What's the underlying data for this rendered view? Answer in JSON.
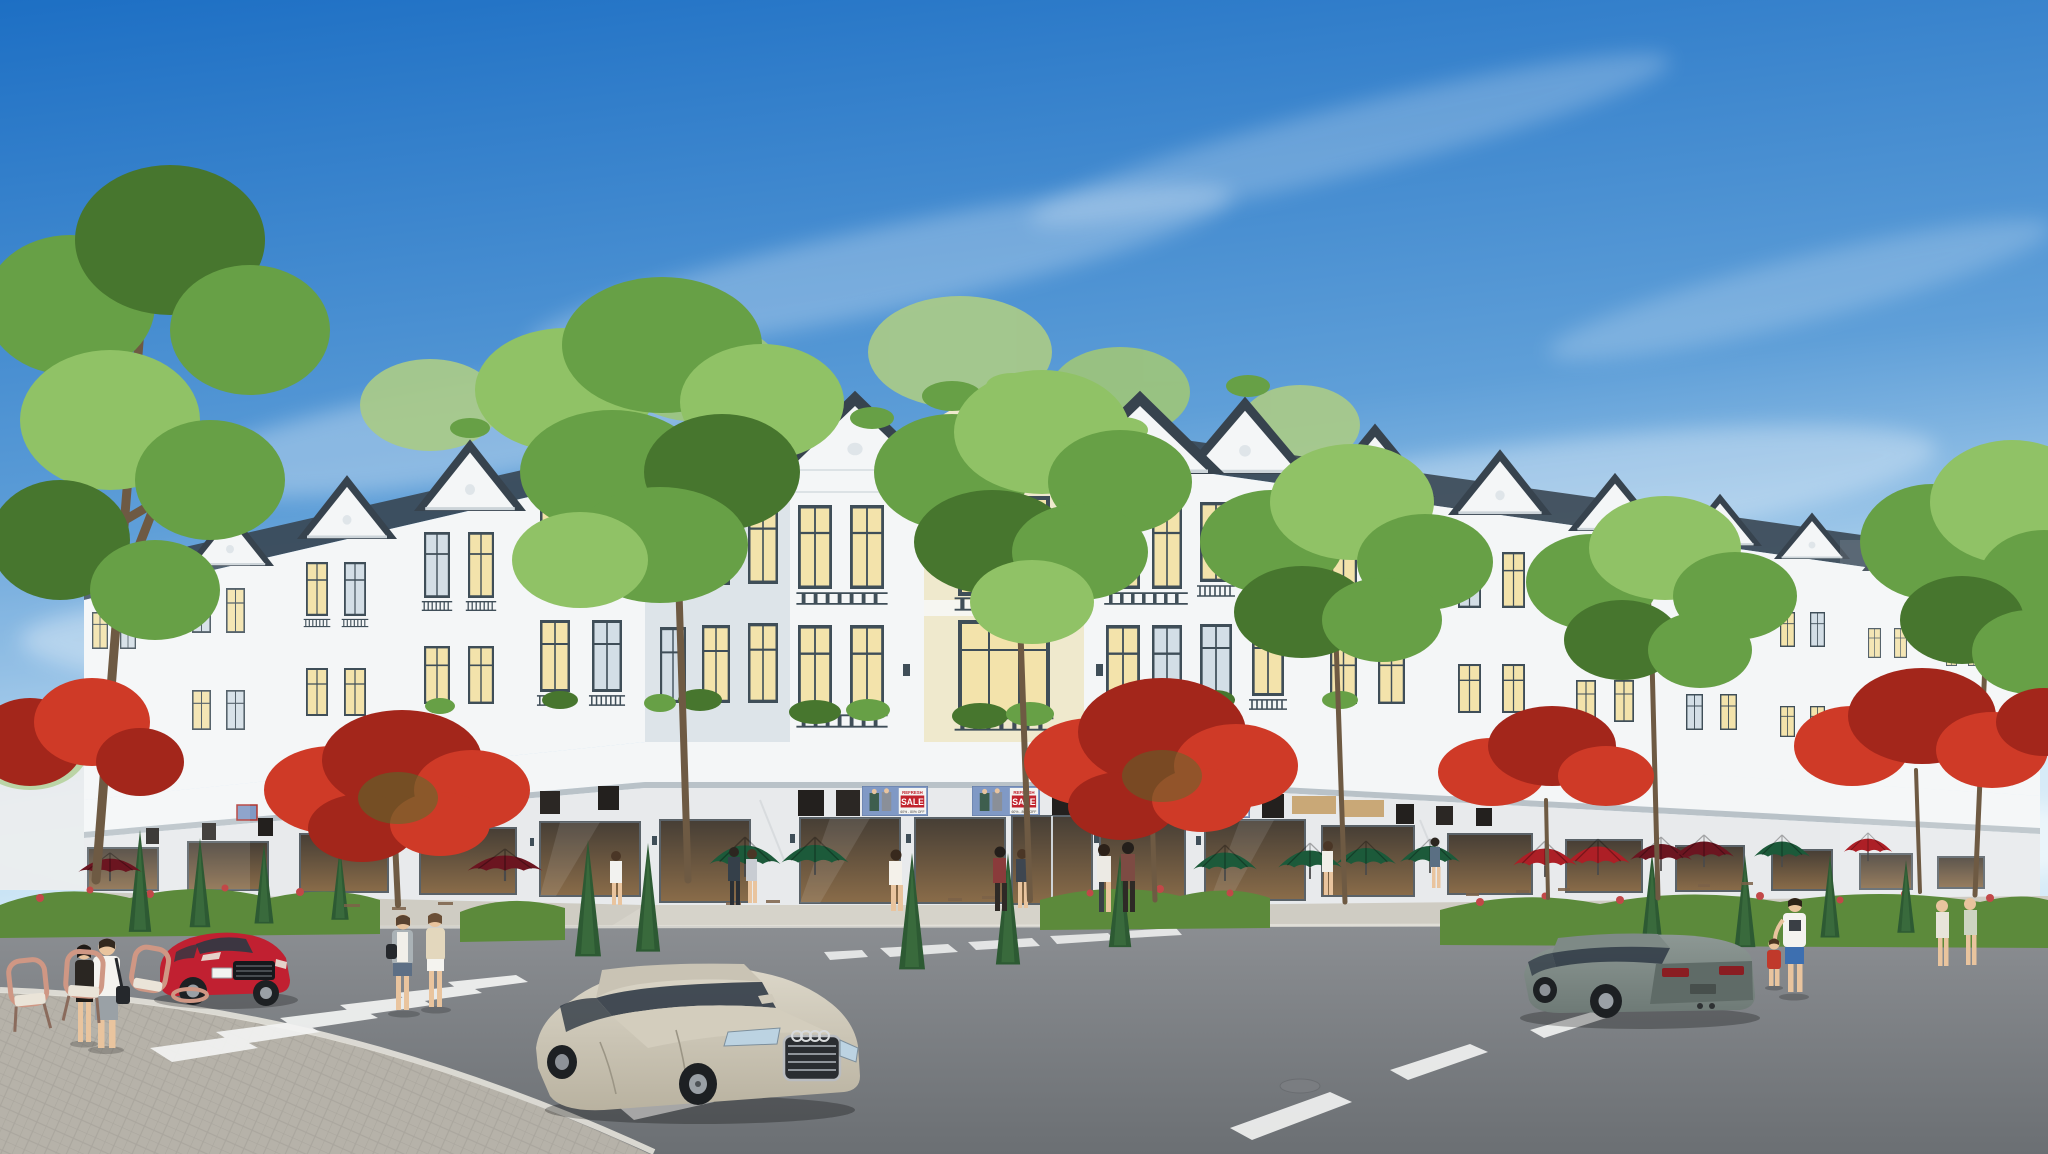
{
  "scene": {
    "kind": "3D architectural rendering",
    "setting": "Sunny street corner of a white neoclassical shophouse row with street trees, cafe umbrellas, pedestrians and three cars",
    "signage": {
      "banner_refresh": "REFRESH",
      "banner_sale": "SALE",
      "banner_subtitle": "60% - 80% OFF"
    },
    "vehicles": [
      {
        "label": "red coupe",
        "position": "left street, facing viewer"
      },
      {
        "label": "champagne sedan",
        "position": "center foreground",
        "badge": "four-ring grille emblem"
      },
      {
        "label": "grey liftback",
        "position": "right street, driving away"
      }
    ],
    "landscape": {
      "street_trees": 6,
      "flame_trees": 5,
      "conifer_shrubs": 13,
      "umbrella_colors": [
        "green",
        "dark red",
        "bright red"
      ]
    },
    "pedestrians": 16
  },
  "colors": {
    "sky-top": "#1d6fc4",
    "sky-mid": "#5f9fd8",
    "sky-low": "#d2e9f7",
    "wall-white": "#f4f6f7",
    "wall-shade": "#dde4e9",
    "wall-cream": "#efe9cd",
    "roof-dark": "#37434e",
    "frame-dark": "#3f4e58",
    "window-warm": "#f3e3ab",
    "window-cool": "#d3dee6",
    "marble": "#e8eaec",
    "marble-vein": "#b9c1c7",
    "shop-dark": "#463e35",
    "shop-warm": "#8a6c49",
    "banner-blue": "#8099c5",
    "banner-red": "#c1232d",
    "tree-green": "#67a046",
    "tree-dark": "#47762e",
    "tree-light": "#90c266",
    "flame-red": "#cf3a27",
    "flame-dark": "#a3261b",
    "conifer": "#2d5a33",
    "hedge": "#5c8a3b",
    "hedge-flower": "#c24848",
    "umbrella-green": "#1c5a3a",
    "umbrella-maroon": "#6b1520",
    "umbrella-red": "#ad1f26",
    "road": "#8b8e92",
    "road-low": "#6b6f73",
    "sidewalk": "#cfccc3",
    "paver": "#b6b2a9",
    "curb": "#e5e3dc",
    "marking": "#f3f4f3",
    "car-red": "#c12031",
    "car-silver": "#b9b2a0",
    "car-silver-light": "#dcd7c9",
    "car-grey": "#6e7a76",
    "car-grey-light": "#8d9894",
    "glass-dark": "#2e3844",
    "trunk": "#6e5a43",
    "skin": "#e9c49e"
  }
}
